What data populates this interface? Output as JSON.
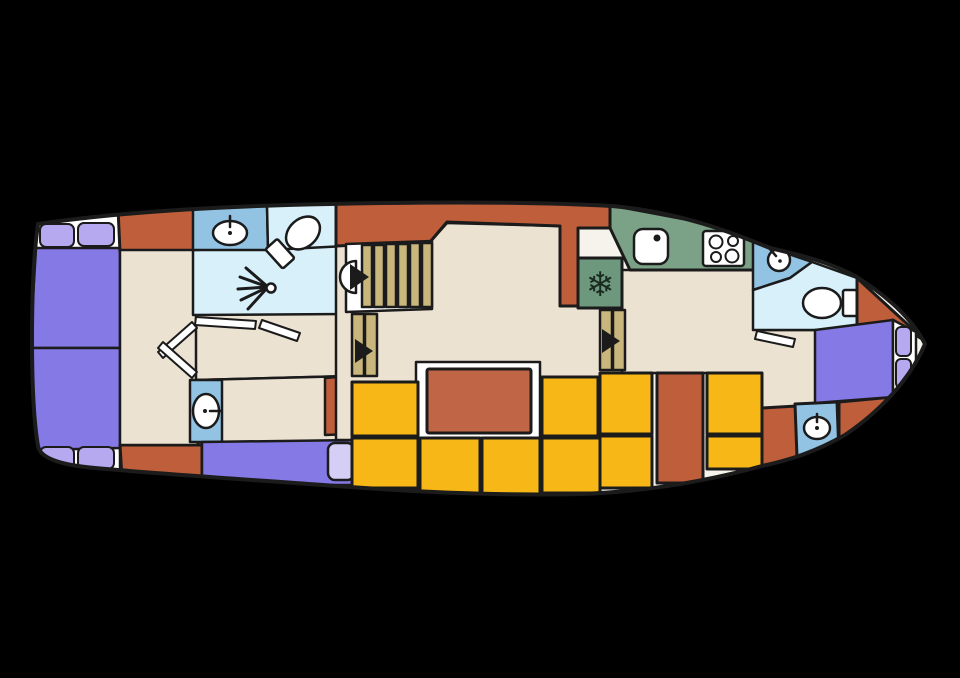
{
  "meta": {
    "type": "boat-deck-floorplan"
  },
  "canvas": {
    "width": 960,
    "height": 678,
    "background": "#000000"
  },
  "palette": {
    "outline": "#1b1b1b",
    "hull": "#f6f3ec",
    "cream": "#ece2d2",
    "rust": "#bf5e3b",
    "rustLight": "#c06545",
    "yellow": "#f7b817",
    "purple": "#8579e5",
    "pillow": "#b6a9ef",
    "pillowLight": "#d6cff5",
    "lightblue": "#d8f0fa",
    "medblue": "#92c3e3",
    "green": "#7ba186",
    "green2": "#6e987e",
    "tan": "#c9b67d",
    "white": "#ffffff",
    "dark": "#192a20"
  },
  "hull": {
    "fill": "hull",
    "path": "M 38 224 C 120 212 220 206 330 204 C 420 202 520 201 612 206 C 680 212 730 232 770 248 C 800 255 830 262 857 277 C 885 295 912 318 925 344 C 912 375 885 408 845 435 C 815 452 790 460 762 466 C 700 483 640 492 580 494 C 500 496 420 492 350 487 C 270 481 160 474 95 468 C 60 465 40 458 38 446 C 30 400 30 280 38 224 Z"
  },
  "icons": {
    "freezer": "snowflake-icon",
    "shower": "shower-spray-icon",
    "stairs": "arrow-triangle-icon"
  },
  "shapes": [
    {
      "name": "stern-mattress-head-top",
      "kind": "polygon",
      "points": "36,216 118,210 120,250 36,250",
      "fill": "white"
    },
    {
      "name": "stern-mattress-head-bottom",
      "kind": "polygon",
      "points": "38,444 120,446 120,476 38,472",
      "fill": "white"
    },
    {
      "name": "stern-bed-top",
      "kind": "polygon",
      "points": "36,248 120,248 120,348 30,348",
      "fill": "purple"
    },
    {
      "name": "stern-bed-bottom",
      "kind": "polygon",
      "points": "30,348 120,348 120,448 36,450",
      "fill": "purple"
    },
    {
      "name": "pillow",
      "kind": "rect",
      "x": 40,
      "y": 224,
      "w": 34,
      "h": 23,
      "rx": 6,
      "fill": "pillow",
      "sw": 2
    },
    {
      "name": "pillow",
      "kind": "rect",
      "x": 78,
      "y": 223,
      "w": 36,
      "h": 23,
      "rx": 6,
      "fill": "pillow",
      "sw": 2
    },
    {
      "name": "pillow",
      "kind": "rect",
      "x": 40,
      "y": 447,
      "w": 34,
      "h": 22,
      "rx": 6,
      "fill": "pillow",
      "sw": 2
    },
    {
      "name": "pillow",
      "kind": "rect",
      "x": 78,
      "y": 447,
      "w": 36,
      "h": 22,
      "rx": 6,
      "fill": "pillow",
      "sw": 2
    },
    {
      "name": "hull-block-orange",
      "kind": "polygon",
      "points": "118,208 196,204 198,252 120,252",
      "fill": "rust",
      "sw": 3
    },
    {
      "name": "hull-block-orange",
      "kind": "polygon",
      "points": "120,445 202,445 202,480 122,478",
      "fill": "rust",
      "sw": 3
    },
    {
      "name": "stern-cabin-floor",
      "kind": "polygon",
      "points": "120,250 198,250 198,445 120,445",
      "fill": "cream"
    },
    {
      "name": "corridor-floor",
      "kind": "polygon",
      "points": "196,312 348,310 348,376 196,380",
      "fill": "cream"
    },
    {
      "name": "shower-room",
      "kind": "polygon",
      "points": "193,250 346,246 346,314 193,315",
      "fill": "lightblue"
    },
    {
      "name": "washbasin-unit-aft",
      "kind": "polygon",
      "points": "193,208 267,205 268,250 193,250",
      "fill": "medblue"
    },
    {
      "name": "wc-room-aft",
      "kind": "polygon",
      "points": "267,205 342,202 346,246 268,250",
      "fill": "lightblue"
    },
    {
      "name": "guest-cabin-floor",
      "kind": "polygon",
      "points": "196,380 352,376 352,442 196,442",
      "fill": "cream"
    },
    {
      "name": "guest-cabin-orange-block",
      "kind": "polygon",
      "points": "325,378 350,376 350,434 325,435",
      "fill": "rust"
    },
    {
      "name": "washbasin-unit-port",
      "kind": "polygon",
      "points": "190,380 222,380 222,442 190,442",
      "fill": "medblue"
    },
    {
      "name": "guest-berth",
      "kind": "polygon",
      "points": "202,442 356,440 356,485 202,485",
      "fill": "purple"
    },
    {
      "name": "guest-berth-pillow",
      "kind": "rect",
      "x": 328,
      "y": 443,
      "w": 26,
      "h": 37,
      "rx": 7,
      "fill": "pillowLight",
      "sw": 2.5
    },
    {
      "name": "saloon-floor",
      "kind": "polygon",
      "points": "336,246 430,242 447,223 560,226 560,306 627,306 627,440 336,440",
      "fill": "cream"
    },
    {
      "name": "galley-floor",
      "kind": "polygon",
      "points": "622,270 757,270 757,330 820,330 816,412 757,412 757,373 622,373",
      "fill": "cream"
    },
    {
      "name": "wheelhouse-bulkhead-orange",
      "kind": "polygon",
      "points": "336,200 612,200 612,228 578,228 578,306 560,306 560,226 447,222 430,242 336,246",
      "fill": "rust",
      "sw": 3
    },
    {
      "name": "galley-counter",
      "kind": "polygon",
      "points": "610,205 700,222 757,242 757,270 630,270 610,228",
      "fill": "green",
      "sw": 3
    },
    {
      "name": "fridge",
      "kind": "rect",
      "x": 578,
      "y": 258,
      "w": 44,
      "h": 50,
      "fill": "green2",
      "sw": 3
    },
    {
      "name": "freezer-snowflake-icon",
      "kind": "text",
      "x": 600,
      "y": 296,
      "text": "❄",
      "size": 34,
      "fill": "dark",
      "sw": 0
    },
    {
      "name": "galley-sink",
      "kind": "rect",
      "x": 634,
      "y": 229,
      "w": 34,
      "h": 35,
      "rx": 9,
      "fill": "white"
    },
    {
      "name": "galley-sink-faucet-dot",
      "kind": "circle",
      "cx": 657,
      "cy": 238,
      "r": 3.5,
      "fill": "outline",
      "sw": 0
    },
    {
      "name": "stove",
      "kind": "rect",
      "x": 703,
      "y": 231,
      "w": 41,
      "h": 35,
      "rx": 3,
      "fill": "white"
    },
    {
      "name": "stove-burner",
      "kind": "circle",
      "cx": 716,
      "cy": 242,
      "r": 6.5,
      "fill": "white",
      "sw": 2
    },
    {
      "name": "stove-burner",
      "kind": "circle",
      "cx": 733,
      "cy": 241,
      "r": 5,
      "fill": "white",
      "sw": 2
    },
    {
      "name": "stove-burner",
      "kind": "circle",
      "cx": 716,
      "cy": 257,
      "r": 5,
      "fill": "white",
      "sw": 2
    },
    {
      "name": "stove-burner",
      "kind": "circle",
      "cx": 732,
      "cy": 256,
      "r": 6.5,
      "fill": "white",
      "sw": 2
    },
    {
      "name": "stairs-main-well",
      "kind": "polygon",
      "points": "346,244 432,241 432,309 346,312",
      "fill": "white"
    },
    {
      "name": "stair-tread",
      "kind": "rect",
      "x": 362,
      "y": 245,
      "w": 10,
      "h": 62,
      "fill": "tan"
    },
    {
      "name": "stair-tread",
      "kind": "rect",
      "x": 374,
      "y": 245,
      "w": 10,
      "h": 62,
      "fill": "tan"
    },
    {
      "name": "stair-tread",
      "kind": "rect",
      "x": 386,
      "y": 244,
      "w": 10,
      "h": 63,
      "fill": "tan"
    },
    {
      "name": "stair-tread",
      "kind": "rect",
      "x": 398,
      "y": 244,
      "w": 10,
      "h": 63,
      "fill": "tan"
    },
    {
      "name": "stair-tread",
      "kind": "rect",
      "x": 410,
      "y": 243,
      "w": 10,
      "h": 64,
      "fill": "tan"
    },
    {
      "name": "stair-tread",
      "kind": "rect",
      "x": 422,
      "y": 243,
      "w": 10,
      "h": 64,
      "fill": "tan"
    },
    {
      "name": "stairs-main-landing",
      "kind": "path",
      "d": "M 356 261 A 16 16 0 0 0 356 293 Z",
      "fill": "white"
    },
    {
      "name": "stairs-main-arrow-icon",
      "kind": "polygon",
      "points": "350,264 350,290 369,277",
      "fill": "outline",
      "sw": 0
    },
    {
      "name": "stair-tread",
      "kind": "rect",
      "x": 352,
      "y": 314,
      "w": 12,
      "h": 62,
      "fill": "tan"
    },
    {
      "name": "stair-tread",
      "kind": "rect",
      "x": 365,
      "y": 314,
      "w": 12,
      "h": 62,
      "fill": "tan"
    },
    {
      "name": "stairs-aft-arrow-icon",
      "kind": "polygon",
      "points": "355,339 355,363 373,351",
      "fill": "outline",
      "sw": 0
    },
    {
      "name": "stair-tread",
      "kind": "rect",
      "x": 600,
      "y": 310,
      "w": 12,
      "h": 60,
      "fill": "tan"
    },
    {
      "name": "stair-tread",
      "kind": "rect",
      "x": 613,
      "y": 310,
      "w": 12,
      "h": 60,
      "fill": "tan"
    },
    {
      "name": "stairs-fwd-arrow-icon",
      "kind": "polygon",
      "points": "602,329 602,353 620,341",
      "fill": "outline",
      "sw": 0
    },
    {
      "name": "table-base",
      "kind": "polygon",
      "points": "416,362 540,362 540,440 416,440",
      "fill": "white"
    },
    {
      "name": "saloon-table",
      "kind": "rect",
      "x": 427,
      "y": 369,
      "w": 104,
      "h": 64,
      "rx": 2,
      "fill": "rustLight",
      "sw": 3
    },
    {
      "name": "bench-seat",
      "kind": "rect",
      "x": 352,
      "y": 382,
      "w": 66,
      "h": 54,
      "fill": "yellow",
      "sw": 3
    },
    {
      "name": "bench-seat",
      "kind": "rect",
      "x": 352,
      "y": 438,
      "w": 66,
      "h": 50,
      "fill": "yellow",
      "sw": 3
    },
    {
      "name": "bench-seat",
      "kind": "rect",
      "x": 420,
      "y": 438,
      "w": 60,
      "h": 56,
      "fill": "yellow",
      "sw": 3
    },
    {
      "name": "bench-seat",
      "kind": "rect",
      "x": 482,
      "y": 438,
      "w": 58,
      "h": 57,
      "fill": "yellow",
      "sw": 3
    },
    {
      "name": "bench-seat",
      "kind": "rect",
      "x": 542,
      "y": 438,
      "w": 58,
      "h": 55,
      "fill": "yellow",
      "sw": 3
    },
    {
      "name": "bench-seat",
      "kind": "rect",
      "x": 542,
      "y": 377,
      "w": 56,
      "h": 59,
      "fill": "yellow",
      "sw": 3
    },
    {
      "name": "bench-seat",
      "kind": "rect",
      "x": 600,
      "y": 373,
      "w": 52,
      "h": 61,
      "fill": "yellow",
      "sw": 3
    },
    {
      "name": "bench-seat",
      "kind": "rect",
      "x": 600,
      "y": 436,
      "w": 52,
      "h": 52,
      "fill": "yellow",
      "sw": 3
    },
    {
      "name": "cockpit-locker",
      "kind": "rect",
      "x": 657,
      "y": 373,
      "w": 46,
      "h": 110,
      "fill": "rust",
      "sw": 3
    },
    {
      "name": "bench-seat",
      "kind": "rect",
      "x": 707,
      "y": 373,
      "w": 55,
      "h": 61,
      "fill": "yellow",
      "sw": 3
    },
    {
      "name": "bench-seat",
      "kind": "rect",
      "x": 707,
      "y": 436,
      "w": 55,
      "h": 33,
      "fill": "yellow",
      "sw": 3
    },
    {
      "name": "hull-block-orange",
      "kind": "polygon",
      "points": "762,408 797,406 797,470 762,470",
      "fill": "rust",
      "sw": 3
    },
    {
      "name": "washbasin-unit-fwd",
      "kind": "polygon",
      "points": "795,404 837,402 839,455 797,457",
      "fill": "medblue",
      "sw": 3
    },
    {
      "name": "bow-hull-wedge-bottom",
      "kind": "polygon",
      "points": "839,402 893,397 928,345 856,448 798,456 839,452",
      "fill": "rust",
      "sw": 3
    },
    {
      "name": "bow-washbasin-corner",
      "kind": "polygon",
      "points": "753,242 812,262 790,278 753,290",
      "fill": "medblue"
    },
    {
      "name": "bow-corner-sink",
      "kind": "circle",
      "cx": 779,
      "cy": 260,
      "r": 11,
      "fill": "white"
    },
    {
      "name": "bow-corner-sink-faucet",
      "kind": "line",
      "x1": 769,
      "y1": 248,
      "x2": 776,
      "y2": 256,
      "sw": 2.5
    },
    {
      "name": "bow-corner-sink-dot",
      "kind": "circle",
      "cx": 780,
      "cy": 261,
      "r": 1.8,
      "fill": "outline",
      "sw": 0
    },
    {
      "name": "wc-room-fwd",
      "kind": "polygon",
      "points": "753,290 790,278 812,262 857,278 857,330 753,330",
      "fill": "lightblue"
    },
    {
      "name": "wc-fwd-cistern",
      "kind": "rect",
      "x": 843,
      "y": 290,
      "w": 14,
      "h": 26,
      "rx": 2,
      "fill": "white"
    },
    {
      "name": "wc-fwd-toilet",
      "kind": "ellipse",
      "cx": 822,
      "cy": 303,
      "rx": 19,
      "ry": 15,
      "fill": "white"
    },
    {
      "name": "bow-hull-wedge-top",
      "kind": "polygon",
      "points": "857,278 928,343 893,320 857,330",
      "fill": "rust",
      "sw": 3
    },
    {
      "name": "bow-bed",
      "kind": "polygon",
      "points": "815,330 893,320 893,397 815,403",
      "fill": "purple"
    },
    {
      "name": "bow-mattress-head",
      "kind": "polygon",
      "points": "893,320 916,332 916,380 893,397",
      "fill": "white"
    },
    {
      "name": "pillow",
      "kind": "rect",
      "x": 896,
      "y": 327,
      "w": 15,
      "h": 29,
      "rx": 5,
      "fill": "pillow",
      "sw": 2
    },
    {
      "name": "pillow",
      "kind": "rect",
      "x": 896,
      "y": 359,
      "w": 15,
      "h": 29,
      "rx": 5,
      "fill": "pillow",
      "sw": 2
    },
    {
      "name": "shower-spray-ray",
      "kind": "line",
      "x1": 268,
      "y1": 287,
      "x2": 246,
      "y2": 268,
      "sw": 3
    },
    {
      "name": "shower-spray-ray",
      "kind": "line",
      "x1": 268,
      "y1": 287,
      "x2": 240,
      "y2": 277,
      "sw": 3
    },
    {
      "name": "shower-spray-ray",
      "kind": "line",
      "x1": 268,
      "y1": 287,
      "x2": 238,
      "y2": 289,
      "sw": 3
    },
    {
      "name": "shower-spray-ray",
      "kind": "line",
      "x1": 268,
      "y1": 287,
      "x2": 241,
      "y2": 300,
      "sw": 3
    },
    {
      "name": "shower-spray-ray",
      "kind": "line",
      "x1": 268,
      "y1": 287,
      "x2": 248,
      "y2": 309,
      "sw": 3
    },
    {
      "name": "shower-head-icon",
      "kind": "circle",
      "cx": 271,
      "cy": 288,
      "r": 4.5,
      "fill": "white",
      "sw": 2.5
    },
    {
      "name": "wc-aft-cistern",
      "kind": "rect",
      "x": 264,
      "y": 220,
      "w": 16,
      "h": 26,
      "rx": 2,
      "fill": "white",
      "rotate": [
        -42,
        303,
        233
      ]
    },
    {
      "name": "wc-aft-toilet",
      "kind": "ellipse",
      "cx": 303,
      "cy": 233,
      "rx": 19,
      "ry": 14,
      "fill": "white",
      "rotate": [
        -42,
        303,
        233
      ]
    },
    {
      "name": "washbasin-aft-sink",
      "kind": "ellipse",
      "cx": 230,
      "cy": 233,
      "rx": 17,
      "ry": 12,
      "fill": "white"
    },
    {
      "name": "washbasin-aft-faucet",
      "kind": "line",
      "x1": 230,
      "y1": 216,
      "x2": 230,
      "y2": 227,
      "sw": 2.5
    },
    {
      "name": "washbasin-aft-dot",
      "kind": "circle",
      "cx": 230,
      "cy": 233,
      "r": 2,
      "fill": "outline",
      "sw": 0
    },
    {
      "name": "washbasin-port-sink",
      "kind": "ellipse",
      "cx": 206,
      "cy": 411,
      "rx": 13,
      "ry": 17,
      "fill": "white"
    },
    {
      "name": "washbasin-port-faucet",
      "kind": "line",
      "x1": 210,
      "y1": 411,
      "x2": 221,
      "y2": 411,
      "sw": 2.5
    },
    {
      "name": "washbasin-port-dot",
      "kind": "circle",
      "cx": 205,
      "cy": 411,
      "r": 2,
      "fill": "outline",
      "sw": 0
    },
    {
      "name": "washbasin-fwd-sink",
      "kind": "ellipse",
      "cx": 817,
      "cy": 428,
      "rx": 13,
      "ry": 11,
      "fill": "white"
    },
    {
      "name": "washbasin-fwd-faucet",
      "kind": "line",
      "x1": 817,
      "y1": 414,
      "x2": 817,
      "y2": 422,
      "sw": 2.5
    },
    {
      "name": "washbasin-fwd-dot",
      "kind": "circle",
      "cx": 817,
      "cy": 428,
      "r": 2,
      "fill": "outline",
      "sw": 0
    },
    {
      "name": "door-leaf",
      "kind": "polygon",
      "points": "158,352 192,322 197,328 163,358",
      "fill": "white",
      "sw": 2
    },
    {
      "name": "door-leaf",
      "kind": "polygon",
      "points": "158,348 192,378 197,372 163,342",
      "fill": "white",
      "sw": 2
    },
    {
      "name": "door-leaf",
      "kind": "polygon",
      "points": "196,317 256,321 255,329 195,325",
      "fill": "white",
      "sw": 2
    },
    {
      "name": "door-leaf",
      "kind": "polygon",
      "points": "262,320 300,333 297,341 259,328",
      "fill": "white",
      "sw": 2
    },
    {
      "name": "door-leaf",
      "kind": "polygon",
      "points": "757,331 795,339 793,347 755,339",
      "fill": "white",
      "sw": 2
    }
  ]
}
